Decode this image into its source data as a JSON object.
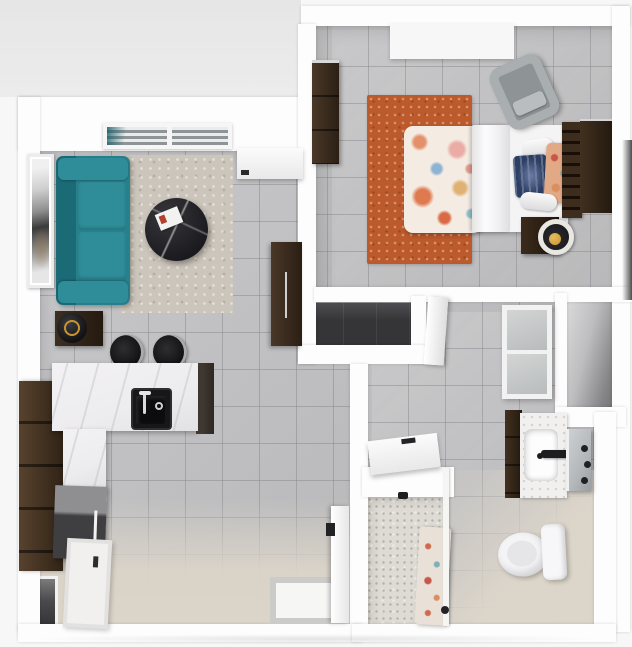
{
  "meta": {
    "title": "Floor plan",
    "view": "3d-top-down-floor-plan",
    "text_content": "none"
  },
  "palette": {
    "outside_bg": "#f7f7f8",
    "patio": "#e9e9e9",
    "wall": "#fdfdfd",
    "tile": "#c2c2c4",
    "tile_grout": "#a5a5a9",
    "entry_beige": "#dcd5c9",
    "closet_floor": "#353537",
    "sofa_teal": "#27818d",
    "sofa_teal_dark": "#1b6b77",
    "sofa_teal_light": "#2f8d99",
    "rug_living": "#ccc5bb",
    "rug_bedroom": "#bd5a2c",
    "wood_dark": "#453325",
    "wood_darker": "#271c12",
    "counter_marble": "#edecee",
    "sink_black": "#17171a",
    "appliance_gray": "#3f3f42",
    "chair_gray": "#9aa0a3",
    "bedding_white": "#f4f4f5",
    "pillow_navy": "#2c3e63",
    "lamp_gold": "#c9952e",
    "mirror_gray": "#b4b7b9",
    "glass_gray": "#c0c3c4",
    "mosaic_floor": "#dedbd5",
    "niche_shadow": "#6a6a6c"
  },
  "scene": {
    "rooms": [
      {
        "name": "living-room",
        "floor": "gray-tile",
        "objects": [
          "window",
          "entry-door",
          "wall-art",
          "teal-sofa",
          "area-rug",
          "round-coffee-table",
          "magazine",
          "media-cabinet",
          "end-table-with-tray"
        ]
      },
      {
        "name": "kitchen",
        "floor": "gray-tile",
        "objects": [
          "pantry-cabinet",
          "marble-island",
          "black-sink",
          "faucet",
          "bar-stool",
          "bar-stool",
          "appliance",
          "white-base-cabinet",
          "storage-niche"
        ]
      },
      {
        "name": "entry",
        "floor": "beige",
        "objects": [
          "entry-door",
          "threshold-mat"
        ]
      },
      {
        "name": "bedroom",
        "floor": "gray-tile",
        "objects": [
          "window",
          "dresser",
          "orange-rug",
          "bed-floral-comforter",
          "white-sheet",
          "bolster-pillows",
          "navy-pillow",
          "floral-pillow",
          "slat-headboard",
          "console",
          "gray-armchair",
          "nightstand",
          "tray-lamp"
        ]
      },
      {
        "name": "closet",
        "floor": "dark",
        "objects": [
          "closet-door"
        ]
      },
      {
        "name": "bathroom",
        "floor": "gray-tile-beige",
        "objects": [
          "glass-panel-door",
          "linen-niche",
          "vanity-cabinet",
          "marble-vanity-top",
          "white-basin",
          "black-faucet",
          "mirror",
          "wall-fixtures",
          "toilet"
        ]
      },
      {
        "name": "shower-room",
        "floor": "mosaic-tile",
        "objects": [
          "shower-door",
          "hinge",
          "floral-shower-curtain",
          "curtain-rail"
        ]
      }
    ]
  }
}
